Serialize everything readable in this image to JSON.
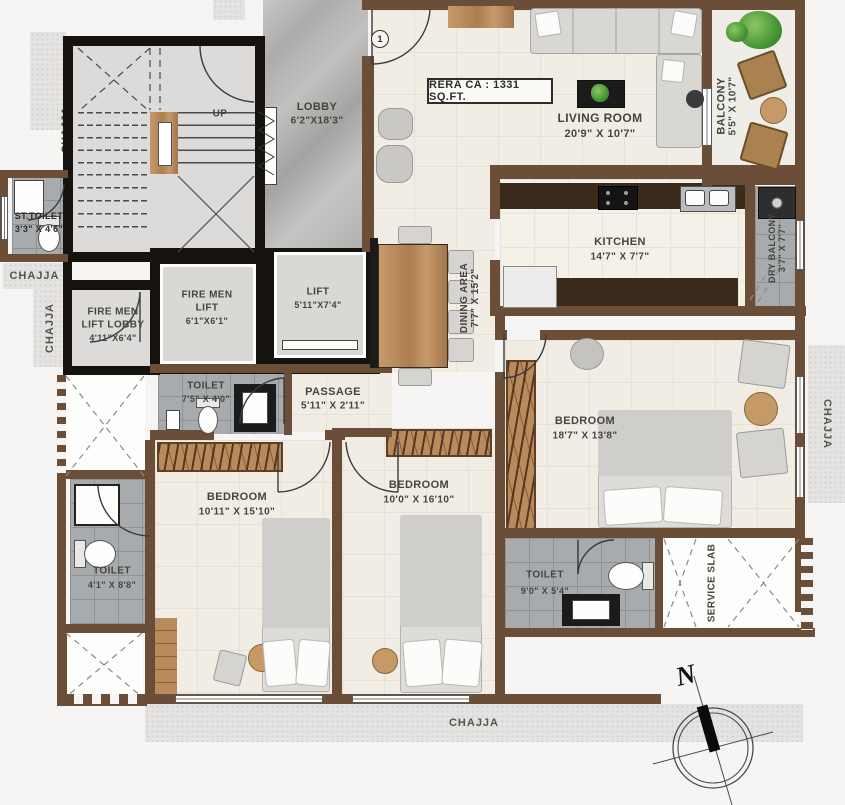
{
  "plan": {
    "type": "residential floor plan",
    "rera_note": "RERA CA : 1331 SQ.FT."
  },
  "labels": {
    "rera": "RERA CA : 1331 SQ.FT.",
    "up": "UP",
    "north": "N",
    "door_tag": "1",
    "chajja": "CHAJJA"
  },
  "rooms": {
    "lobby": {
      "name": "LOBBY",
      "dims": "6'2\"X18'3\""
    },
    "living": {
      "name": "LIVING ROOM",
      "dims": "20'9\" X 10'7\""
    },
    "balcony": {
      "name": "BALCONY",
      "dims": "5'5\" X 10'7\""
    },
    "kitchen": {
      "name": "KITCHEN",
      "dims": "14'7\" X 7'7\""
    },
    "dry_balcony": {
      "name": "DRY BALCONY",
      "dims": "3'7\" X 7'7\""
    },
    "dining": {
      "name": "DINING AREA",
      "dims": "7'7\" X 15'2\""
    },
    "st_toilet": {
      "name": "ST.TOILET",
      "dims": "3'3\" X 4'6\""
    },
    "fire_lift_lobby": {
      "name1": "FIRE MEN",
      "name2": "LIFT LOBBY",
      "dims": "4'11\"X6'4\""
    },
    "fire_lift": {
      "name1": "FIRE MEN",
      "name2": "LIFT",
      "dims": "6'1\"X6'1\""
    },
    "lift": {
      "name": "LIFT",
      "dims": "5'11\"X7'4\""
    },
    "toilet_common": {
      "name": "TOILET",
      "dims": "7'5\" X 4'0\""
    },
    "passage": {
      "name": "PASSAGE",
      "dims": "5'11\" X 2'11\""
    },
    "bedroom_master": {
      "name": "BEDROOM",
      "dims": "18'7\" X 13'8\""
    },
    "bedroom_1": {
      "name": "BEDROOM",
      "dims": "10'11\" X 15'10\""
    },
    "bedroom_2": {
      "name": "BEDROOM",
      "dims": "10'0\" X 16'10\""
    },
    "toilet_small": {
      "name": "TOILET",
      "dims": "4'1\" X 8'8\""
    },
    "toilet_master": {
      "name": "TOILET",
      "dims": "9'0\" X 5'4\""
    },
    "service_slab": {
      "name": "SERVICE SLAB"
    }
  }
}
